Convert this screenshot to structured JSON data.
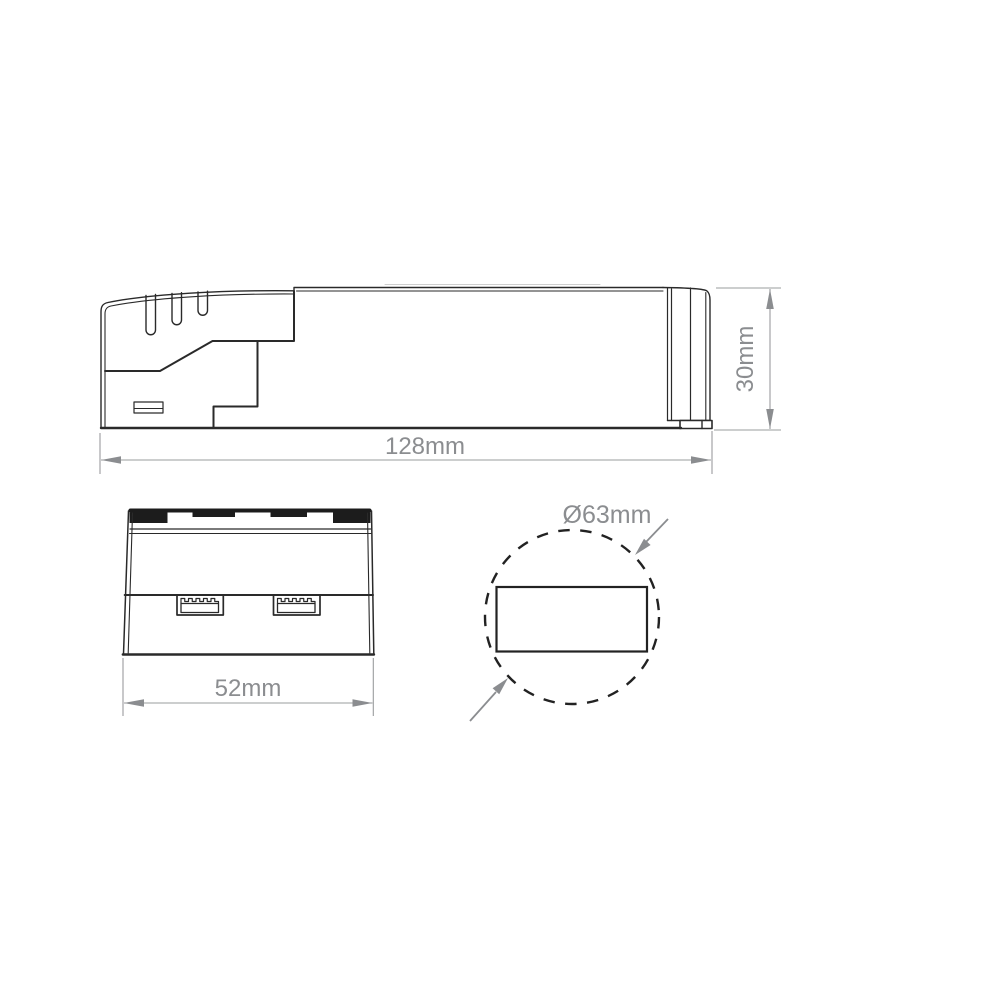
{
  "drawing": {
    "type": "technical-dimension-drawing",
    "dimensions": {
      "length": "128mm",
      "height": "30mm",
      "width": "52mm",
      "hole_diameter": "Ø63mm"
    },
    "colors": {
      "outline": "#2a2a2a",
      "dimension_line": "#9a9c9e",
      "dimension_text": "#8b8d90",
      "background": "#ffffff"
    }
  }
}
